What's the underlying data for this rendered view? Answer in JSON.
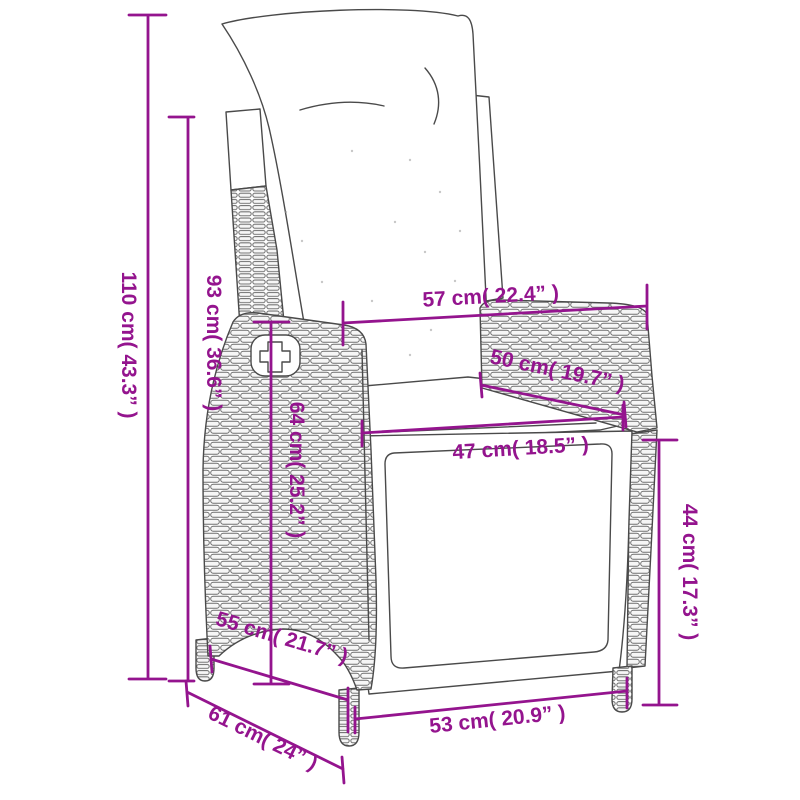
{
  "diagram": {
    "background": "#ffffff",
    "accent_color": "#94148E",
    "outline_color": "#4a4a4a",
    "subject": "reclining rattan garden chair with cushions, line drawing with measurements",
    "dimensions": [
      {
        "name": "total-height",
        "label": "110 cm( 43.3” )",
        "cm": "110",
        "inches": "43.3"
      },
      {
        "name": "backrest-height",
        "label": "93 cm( 36.6” )",
        "cm": "93",
        "inches": "36.6"
      },
      {
        "name": "overall-top-width",
        "label": "57 cm( 22.4” )",
        "cm": "57",
        "inches": "22.4"
      },
      {
        "name": "armrest-length",
        "label": "50 cm( 19.7” )",
        "cm": "50",
        "inches": "19.7"
      },
      {
        "name": "seat-width",
        "label": "47 cm( 18.5” )",
        "cm": "47",
        "inches": "18.5"
      },
      {
        "name": "armrest-height",
        "label": "64 cm( 25.2” )",
        "cm": "64",
        "inches": "25.2"
      },
      {
        "name": "seat-depth",
        "label": "55 cm( 21.7” )",
        "cm": "55",
        "inches": "21.7"
      },
      {
        "name": "front-height",
        "label": "44 cm( 17.3” )",
        "cm": "44",
        "inches": "17.3"
      },
      {
        "name": "front-width",
        "label": "53 cm( 20.9” )",
        "cm": "53",
        "inches": "20.9"
      },
      {
        "name": "base-depth",
        "label": "61 cm( 24” )",
        "cm": "61",
        "inches": "24"
      }
    ]
  }
}
